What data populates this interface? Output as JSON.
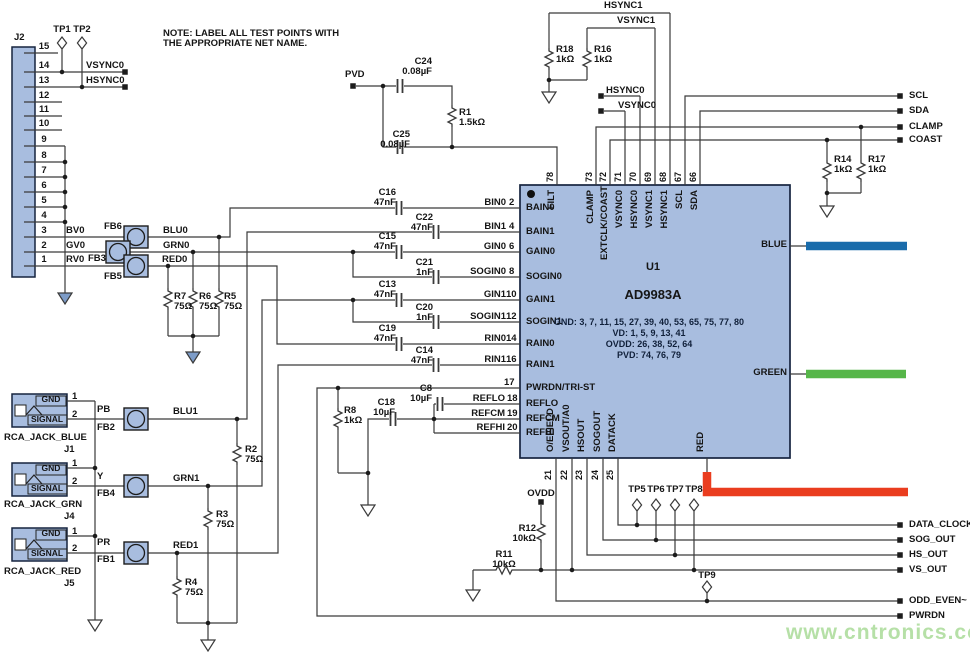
{
  "note": {
    "line1": "NOTE: LABEL ALL TEST POINTS WITH",
    "line2": "THE APPROPRIATE NET NAME."
  },
  "watermark": "www.cntronics.com",
  "colors": {
    "chip_fill": "#a8bddf",
    "blue_bar": "#1a6cab",
    "green_bar": "#56b649",
    "red_bar": "#ea3d1f",
    "watermark": "#b6e0a7"
  },
  "j2": {
    "ref": "J2",
    "pin_numbers": [
      "15",
      "14",
      "13",
      "12",
      "11",
      "10",
      "9",
      "8",
      "7",
      "6",
      "5",
      "4",
      "3",
      "2",
      "1"
    ],
    "pin_nets": {
      "bv0": "BV0",
      "gv0": "GV0",
      "rv0": "RV0"
    }
  },
  "testpoints": {
    "tp1": "TP1",
    "tp2": "TP2",
    "tp5": "TP5",
    "tp6": "TP6",
    "tp7": "TP7",
    "tp8": "TP8",
    "tp9": "TP9"
  },
  "nets": {
    "vsync0": "VSYNC0",
    "hsync0": "HSYNC0",
    "hsync1": "HSYNC1",
    "vsync1": "VSYNC1",
    "pvd": "PVD",
    "scl": "SCL",
    "sda": "SDA",
    "clamp": "CLAMP",
    "coast": "COAST",
    "blu0": "BLU0",
    "grn0": "GRN0",
    "red0": "RED0",
    "blu1": "BLU1",
    "grn1": "GRN1",
    "red1": "RED1",
    "pb": "PB",
    "y": "Y",
    "pr": "PR",
    "bin0": "BIN0",
    "bin1": "BIN1",
    "gin0": "GIN0",
    "sogin0": "SOGIN0",
    "gin1": "GIN1",
    "sogin1": "SOGIN1",
    "rin0": "RIN0",
    "rin1": "RIN1",
    "reflo": "REFLO",
    "refcm": "REFCM",
    "refhi": "REFHI",
    "ovdd": "OVDD",
    "data_clock": "DATA_CLOCK",
    "sog_out": "SOG_OUT",
    "hs_out": "HS_OUT",
    "vs_out": "VS_OUT",
    "odd_even": "ODD_EVEN~",
    "pwrdn": "PWRDN"
  },
  "components": {
    "r1": {
      "ref": "R1",
      "value": "1.5kΩ"
    },
    "r2": {
      "ref": "R2",
      "value": "75Ω"
    },
    "r3": {
      "ref": "R3",
      "value": "75Ω"
    },
    "r4": {
      "ref": "R4",
      "value": "75Ω"
    },
    "r5": {
      "ref": "R5",
      "value": "75Ω"
    },
    "r6": {
      "ref": "R6",
      "value": "75Ω"
    },
    "r7": {
      "ref": "R7",
      "value": "75Ω"
    },
    "r8": {
      "ref": "R8",
      "value": "1kΩ"
    },
    "r11": {
      "ref": "R11",
      "value": "10kΩ"
    },
    "r12": {
      "ref": "R12",
      "value": "10kΩ"
    },
    "r14": {
      "ref": "R14",
      "value": "1kΩ"
    },
    "r16": {
      "ref": "R16",
      "value": "1kΩ"
    },
    "r17": {
      "ref": "R17",
      "value": "1kΩ"
    },
    "r18": {
      "ref": "R18",
      "value": "1kΩ"
    },
    "c8": {
      "ref": "C8",
      "value": "10µF"
    },
    "c13": {
      "ref": "C13",
      "value": "47nF"
    },
    "c14": {
      "ref": "C14",
      "value": "47nF"
    },
    "c15": {
      "ref": "C15",
      "value": "47nF"
    },
    "c16": {
      "ref": "C16",
      "value": "47nF"
    },
    "c18": {
      "ref": "C18",
      "value": "10µF"
    },
    "c19": {
      "ref": "C19",
      "value": "47nF"
    },
    "c20": {
      "ref": "C20",
      "value": "1nF"
    },
    "c21": {
      "ref": "C21",
      "value": "1nF"
    },
    "c22": {
      "ref": "C22",
      "value": "47nF"
    },
    "c24": {
      "ref": "C24",
      "value": "0.08µF"
    },
    "c25": {
      "ref": "C25",
      "value": "0.08µF"
    },
    "fb1": {
      "ref": "FB1"
    },
    "fb2": {
      "ref": "FB2"
    },
    "fb3": {
      "ref": "FB3"
    },
    "fb4": {
      "ref": "FB4"
    },
    "fb5": {
      "ref": "FB5"
    },
    "fb6": {
      "ref": "FB6"
    }
  },
  "chip": {
    "ref": "U1",
    "part": "AD9983A",
    "power_notes": [
      "GND: 3, 7, 11, 15, 27, 39, 40, 53, 65, 75, 77, 80",
      "VD: 1, 5, 9, 13, 41",
      "OVDD: 26, 38, 52, 64",
      "PVD: 74, 76, 79"
    ],
    "left_pins": [
      {
        "num": "2",
        "name": "BAIN0"
      },
      {
        "num": "4",
        "name": "BAIN1"
      },
      {
        "num": "6",
        "name": "GAIN0"
      },
      {
        "num": "8",
        "name": "SOGIN0"
      },
      {
        "num": "10",
        "name": "GAIN1"
      },
      {
        "num": "12",
        "name": "SOGIN1"
      },
      {
        "num": "14",
        "name": "RAIN0"
      },
      {
        "num": "16",
        "name": "RAIN1"
      },
      {
        "num": "17",
        "name": "PWRDN/TRI-ST"
      },
      {
        "num": "18",
        "name": "REFLO"
      },
      {
        "num": "19",
        "name": "REFCM"
      },
      {
        "num": "20",
        "name": "REFHI"
      }
    ],
    "top_pins": [
      {
        "num": "78",
        "name": "FILT"
      },
      {
        "num": "73",
        "name": "CLAMP"
      },
      {
        "num": "72",
        "name": "EXTCLK/COAST"
      },
      {
        "num": "71",
        "name": "VSYNC0"
      },
      {
        "num": "70",
        "name": "HSYNC0"
      },
      {
        "num": "69",
        "name": "VSYNC1"
      },
      {
        "num": "68",
        "name": "HSYNC1"
      },
      {
        "num": "67",
        "name": "SCL"
      },
      {
        "num": "66",
        "name": "SDA"
      }
    ],
    "bottom_pins": [
      {
        "num": "21",
        "name": "O/EFIELD"
      },
      {
        "num": "22",
        "name": "VSOUT/A0"
      },
      {
        "num": "23",
        "name": "HSOUT"
      },
      {
        "num": "24",
        "name": "SOGOUT"
      },
      {
        "num": "25",
        "name": "DATACK"
      }
    ],
    "right_labels": {
      "blue": "BLUE",
      "green": "GREEN",
      "red": "RED"
    }
  },
  "jacks": [
    {
      "name": "RCA_JACK_BLUE",
      "ref": "J1",
      "gnd": "GND",
      "signal": "SIGNAL",
      "pin1": "1",
      "pin2": "2"
    },
    {
      "name": "RCA_JACK_GRN",
      "ref": "J4",
      "gnd": "GND",
      "signal": "SIGNAL",
      "pin1": "1",
      "pin2": "2"
    },
    {
      "name": "RCA_JACK_RED",
      "ref": "J5",
      "gnd": "GND",
      "signal": "SIGNAL",
      "pin1": "1",
      "pin2": "2"
    }
  ]
}
